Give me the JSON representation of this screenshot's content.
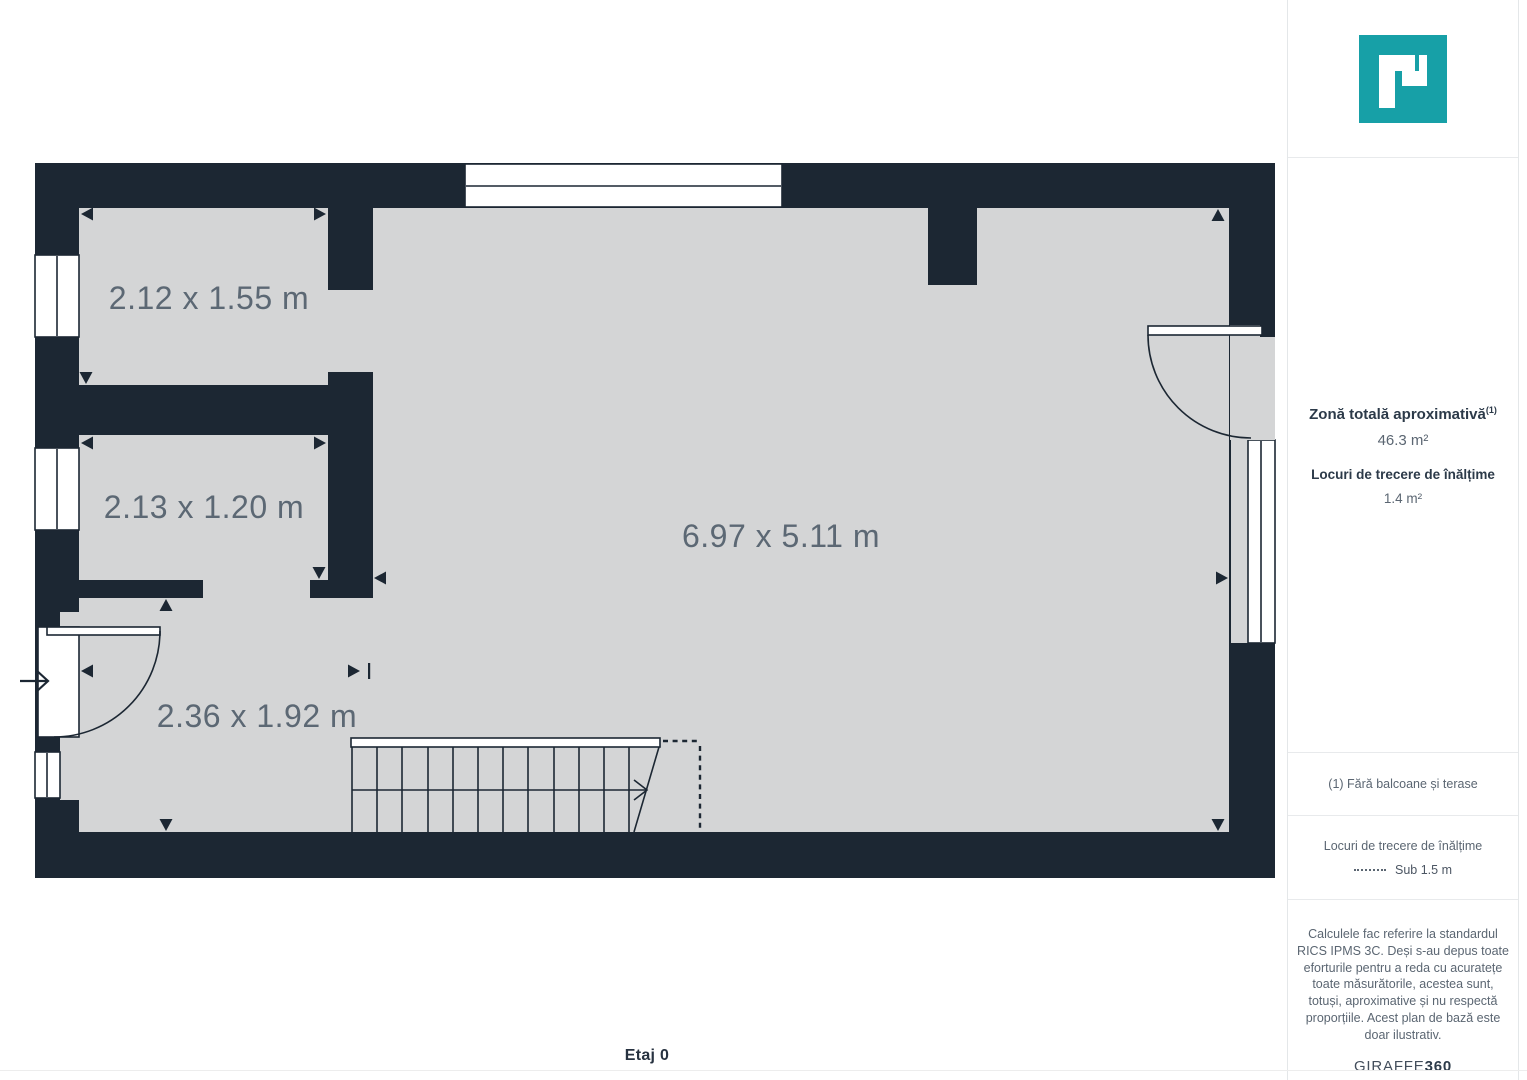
{
  "colors": {
    "wall": "#1c2733",
    "floor": "#d4d5d6",
    "accent_teal": "#17a0a7",
    "plan_label": "#5c6874",
    "text_dark": "#2c3a49",
    "text_muted": "#5b6672"
  },
  "floor_plan": {
    "floor_label": "Etaj 0",
    "rooms": [
      {
        "label": "2.12 x 1.55 m"
      },
      {
        "label": "2.13 x 1.20 m"
      },
      {
        "label": "6.97 x 5.11 m"
      },
      {
        "label": "2.36 x 1.92 m"
      }
    ]
  },
  "sidebar": {
    "logo_icon": "giraffe360-p-logo",
    "total_area": {
      "title": "Zonă totală aproximativă",
      "superscript": "(1)",
      "value": "46.3 m²"
    },
    "headroom": {
      "title": "Locuri de trecere de înălțime",
      "value": "1.4 m²"
    },
    "footnote": "(1) Fără balcoane și terase",
    "legend": {
      "title": "Locuri de trecere de înălțime",
      "item": "Sub 1.5 m"
    },
    "disclaimer": "Calculele fac referire la standardul RICS IPMS 3C. Deși s-au depus toate eforturile pentru a reda cu acuratețe toate măsurătorile, acestea sunt, totuși, aproximative și nu respectă proporțiile. Acest plan de bază este doar ilustrativ.",
    "brand": {
      "name": "GIRAFFE",
      "suffix": "360"
    }
  }
}
